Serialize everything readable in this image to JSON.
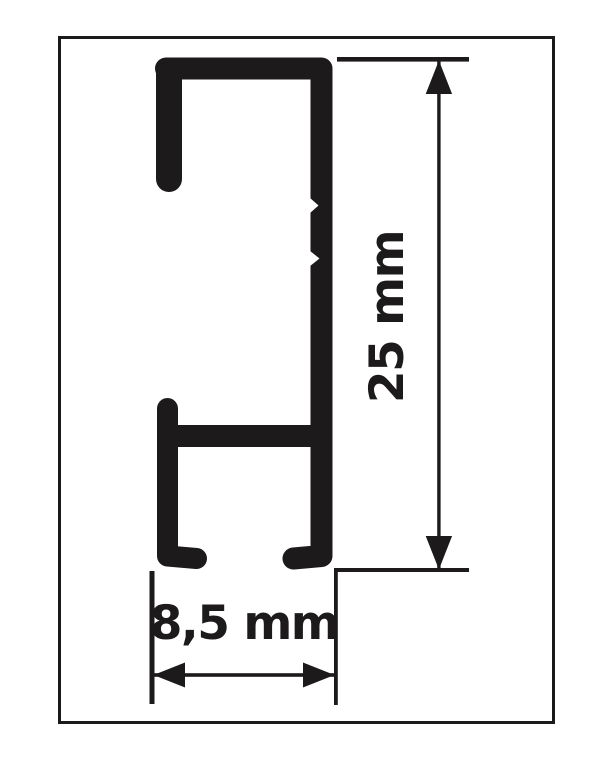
{
  "drawing": {
    "type": "profile-cross-section-diagram",
    "labels": {
      "height": "25 mm",
      "width": "8,5 mm"
    },
    "dimensions": [
      {
        "value": "25 mm",
        "orientation": "vertical",
        "measures": "profile height"
      },
      {
        "value": "8,5 mm",
        "orientation": "horizontal",
        "measures": "profile depth"
      }
    ],
    "colors": {
      "ink": "#1d1a1b",
      "frame_border": "#1a1a1a",
      "background": "#ffffff"
    }
  }
}
